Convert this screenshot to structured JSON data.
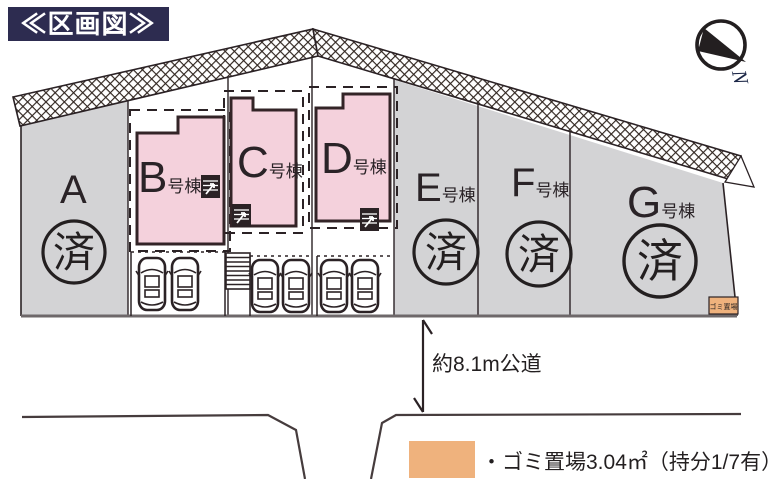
{
  "title": "≪区画図≫",
  "compass": {
    "north_label": "N"
  },
  "lots": [
    {
      "label": "A",
      "suffix": "",
      "status": "済"
    },
    {
      "label": "B",
      "suffix": "号棟",
      "status": ""
    },
    {
      "label": "C",
      "suffix": "号棟",
      "status": ""
    },
    {
      "label": "D",
      "suffix": "号棟",
      "status": ""
    },
    {
      "label": "E",
      "suffix": "号棟",
      "status": "済"
    },
    {
      "label": "F",
      "suffix": "号棟",
      "status": "済"
    },
    {
      "label": "G",
      "suffix": "号棟",
      "status": "済"
    }
  ],
  "road": {
    "label": "約8.1m公道"
  },
  "garbage": {
    "map_label": "ゴミ置場",
    "legend_text": "・ゴミ置場3.04㎡（持分1/7有）"
  },
  "colors": {
    "title_bg": "#2d2c50",
    "lot_gray": "#d3d3d5",
    "building_pink": "#f4d1dc",
    "garbage_orange": "#efb27d",
    "line_dark": "#2b2225"
  }
}
